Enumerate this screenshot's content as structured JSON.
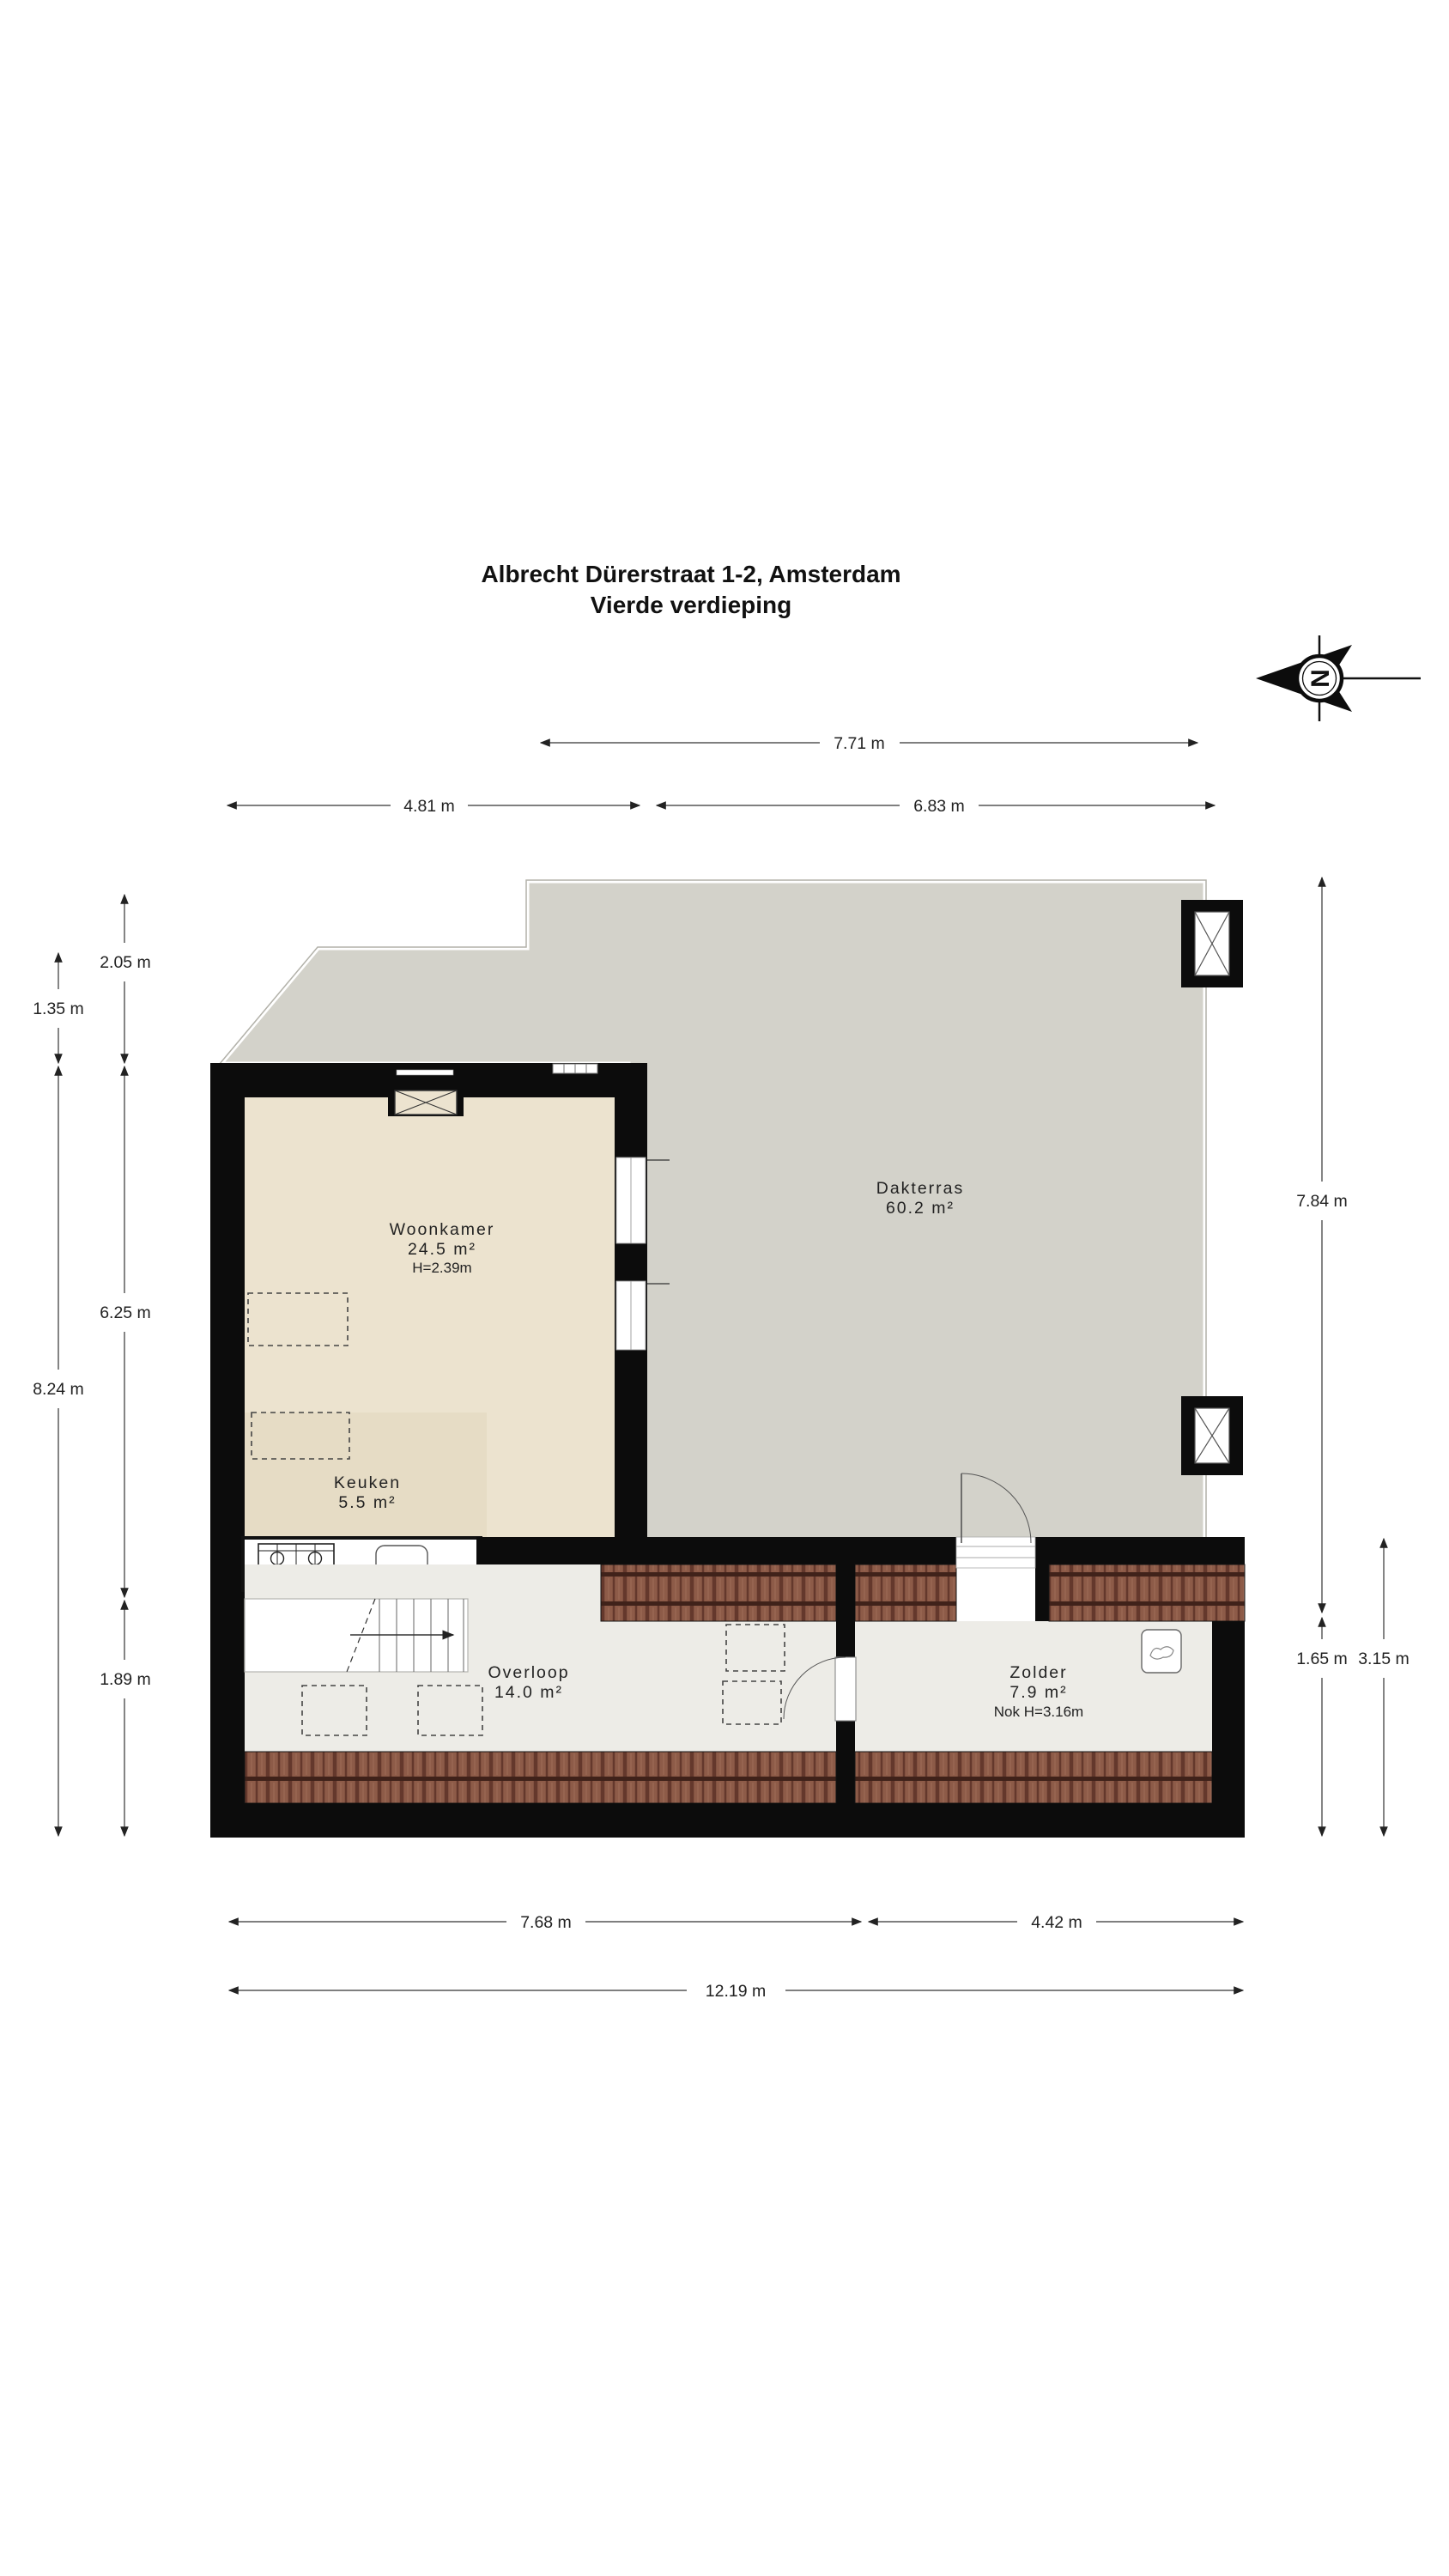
{
  "title": {
    "line1": "Albrecht Dürerstraat 1-2, Amsterdam",
    "line2": "Vierde verdieping"
  },
  "compass": {
    "letter": "N"
  },
  "rooms": {
    "woonkamer": {
      "name": "Woonkamer",
      "area": "24.5 m²",
      "height": "H=2.39m"
    },
    "dakterras": {
      "name": "Dakterras",
      "area": "60.2 m²"
    },
    "keuken": {
      "name": "Keuken",
      "area": "5.5 m²"
    },
    "overloop": {
      "name": "Overloop",
      "area": "14.0 m²"
    },
    "zolder": {
      "name": "Zolder",
      "area": "7.9 m²",
      "ridge_height": "Nok H=3.16m"
    }
  },
  "dimensions": {
    "top_total": "7.71 m",
    "top_left": "4.81 m",
    "top_right": "6.83 m",
    "left_inner_top": "2.05 m",
    "left_outer_top": "1.35 m",
    "left_inner_middle": "6.25 m",
    "left_outer_middle": "8.24 m",
    "left_inner_bottom": "1.89 m",
    "right_terrace": "7.84 m",
    "right_inner_bottom": "1.65 m",
    "right_outer_bottom": "3.15 m",
    "bottom_left": "7.68 m",
    "bottom_right": "4.42 m",
    "bottom_total": "12.19 m"
  },
  "colors": {
    "wall": "#0c0c0c",
    "terrace_floor": "#d3d2ca",
    "living_floor": "#ece3cf",
    "kitchen_floor": "#e6dcc5",
    "landing_floor": "#edece7",
    "roof_tile": "#8d5b48"
  }
}
